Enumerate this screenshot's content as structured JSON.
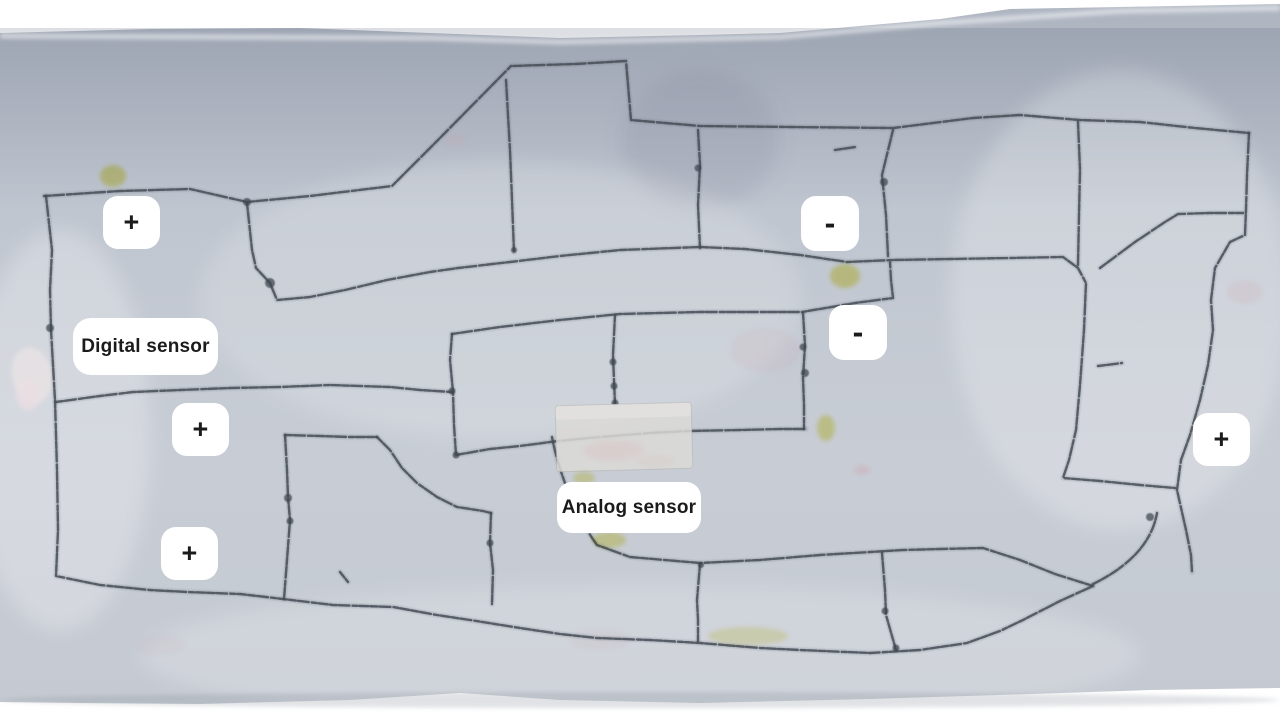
{
  "annotations": {
    "chip_color": "#ffffff",
    "text_color": "#1b1b1b",
    "labels": [
      {
        "name": "label-plus-top-left",
        "text": "+",
        "x": 103,
        "y": 196,
        "w": 57,
        "h": 53,
        "radius": 15,
        "font_size": 27
      },
      {
        "name": "label-minus-top",
        "text": "-",
        "x": 801,
        "y": 196,
        "w": 58,
        "h": 55,
        "radius": 15,
        "font_size": 32
      },
      {
        "name": "label-minus-middle",
        "text": "-",
        "x": 829,
        "y": 305,
        "w": 58,
        "h": 55,
        "radius": 15,
        "font_size": 32
      },
      {
        "name": "label-digital-sensor",
        "text": "Digital sensor",
        "x": 73,
        "y": 318,
        "w": 145,
        "h": 57,
        "radius": 18,
        "font_size": 19
      },
      {
        "name": "label-plus-middle-left",
        "text": "+",
        "x": 172,
        "y": 403,
        "w": 57,
        "h": 53,
        "radius": 15,
        "font_size": 27
      },
      {
        "name": "label-analog-sensor",
        "text": "Analog sensor",
        "x": 557,
        "y": 482,
        "w": 144,
        "h": 51,
        "radius": 15,
        "font_size": 19
      },
      {
        "name": "label-plus-bottom-left",
        "text": "+",
        "x": 161,
        "y": 527,
        "w": 57,
        "h": 53,
        "radius": 15,
        "font_size": 27
      },
      {
        "name": "label-plus-right",
        "text": "+",
        "x": 1193,
        "y": 413,
        "w": 57,
        "h": 53,
        "radius": 15,
        "font_size": 27
      }
    ]
  },
  "sketch": {
    "stroke_color": "#454c55",
    "knot_color": "#3e454e",
    "highlight_color": "#e3dd55",
    "cloth": {
      "outline": "M0,33 L150,29 L300,28 L430,33 L560,38 L700,35 L780,33 L860,26 L940,19 L1010,9 L1120,7 L1280,4 L1280,688 L1150,690 L1000,695 L870,699 L700,703 L560,700 L460,693 L350,700 L200,704 L80,703 L0,702 Z",
      "top_color": "#aeb5c1",
      "mid_color": "#c0c6d0",
      "base_color": "#c8cdd5"
    },
    "tape": {
      "x": 556,
      "y": 404,
      "w": 136,
      "h": 66,
      "rotate": -1.5,
      "color": "#dbd9d6"
    },
    "paths": [
      "M44,196 L120,191 L190,189 L247,202 L310,196 L392,186 L438,140 L511,66 L575,64 L626,61 L631,120 L700,126 L790,127 L893,128 L973,118 L1020,115 L1080,120 L1140,122 L1195,128 L1249,133",
      "M46,196 L52,250 L50,290 L51,330 L55,400 L57,470 L58,530 L56,576 L100,585 L150,590 L187,592 L240,594 L283,599 L333,605 L393,607 L437,615 L470,620 L520,628 L560,634 L597,638 L650,640 L700,643 L760,648 L800,650 L870,653 L920,650 L967,643 L1000,631 L1023,620 L1060,601 L1093,586",
      "M247,203 L252,250 L256,268 L270,283 L277,300 L310,297 L345,290 L387,280 L430,272 L458,268 L510,262 L560,256 L620,250 L700,247 L745,249 L800,255 L847,262 L893,260 L950,259 L1010,258 L1063,257 L1078,268 L1086,283 L1084,330 L1080,385 L1076,430 L1069,460 L1063,478 L1100,481 L1140,485 L1175,488",
      "M506,80 L510,150 L512,200 L514,252",
      "M698,130 L700,165 L698,205 L700,248",
      "M893,130 L882,175 L886,215 L888,256",
      "M1078,122 L1080,170 L1079,215 L1078,265",
      "M1249,133 L1247,175 L1246,210 L1245,235 L1230,242 L1215,268 L1211,300 L1213,330 L1208,365 L1200,400 L1190,435 L1181,460 L1177,490 L1186,530 L1191,555 L1192,572",
      "M1100,268 L1135,242 L1165,222 L1178,214 L1210,213 L1243,213",
      "M452,334 L500,327 L560,320 L620,314 L700,312 L760,312 L802,312 L855,303 L893,298 L891,280 L890,262",
      "M452,334 L450,360 L453,392 L454,425 L456,455 L490,449 L520,446 L558,441 L600,437 L650,433 L687,431 L740,430 L780,429 L806,429",
      "M56,402 L100,396 L133,392 L180,390 L230,388 L280,387 L330,385 L390,387 L420,390 L452,392",
      "M803,313 L805,345 L803,378 L804,405 L804,429",
      "M285,435 L320,436 L350,437 L377,437",
      "M285,435 L287,470 L288,497 L290,520 L287,560 L284,599",
      "M377,437 L390,450 L402,468 L417,483 L437,497 L457,507 L483,511 L491,513",
      "M491,513 L490,543 L493,570 L492,604",
      "M552,437 C558,470 575,515 597,545 L630,557 L700,563 L760,560 L820,555 L870,552 L903,550 L940,549 L983,548 L1020,560 L1055,574 L1093,586",
      "M1157,513 C1152,542 1130,566 1093,584",
      "M700,564 L697,600 L698,620 L698,641",
      "M882,553 L885,590 L886,615 L896,650",
      "M615,315 L613,355 L614,380 L615,404",
      "M1098,366 L1122,363",
      "M835,150 L855,147",
      "M340,572 L348,582"
    ],
    "knots": [
      [
        247,
        202,
        4
      ],
      [
        270,
        283,
        5
      ],
      [
        50,
        328,
        4
      ],
      [
        452,
        391,
        3.5
      ],
      [
        456,
        455,
        3.5
      ],
      [
        613,
        362,
        3.5
      ],
      [
        614,
        386,
        3.5
      ],
      [
        803,
        347,
        3.5
      ],
      [
        805,
        373,
        4
      ],
      [
        698,
        168,
        3.5
      ],
      [
        884,
        182,
        4
      ],
      [
        885,
        611,
        3.5
      ],
      [
        288,
        498,
        4
      ],
      [
        290,
        521,
        3.5
      ],
      [
        490,
        543,
        3.5
      ],
      [
        1150,
        517,
        4
      ],
      [
        896,
        648,
        3.5
      ],
      [
        701,
        565,
        3
      ],
      [
        514,
        250,
        3
      ],
      [
        615,
        403,
        3.5
      ]
    ],
    "highlights": [
      [
        113,
        176,
        13,
        11,
        0.6
      ],
      [
        845,
        276,
        15,
        12,
        0.6
      ],
      [
        826,
        428,
        9,
        13,
        0.55
      ],
      [
        584,
        478,
        11,
        6,
        0.45
      ],
      [
        609,
        540,
        17,
        8,
        0.5
      ],
      [
        748,
        636,
        40,
        9,
        0.3
      ]
    ],
    "smudges": [
      [
        765,
        350,
        35,
        22,
        0.12
      ],
      [
        1245,
        292,
        18,
        12,
        0.15
      ],
      [
        862,
        470,
        8,
        5,
        0.3
      ],
      [
        620,
        452,
        28,
        12,
        0.18
      ],
      [
        600,
        640,
        30,
        10,
        0.1
      ],
      [
        455,
        140,
        10,
        6,
        0.15
      ],
      [
        160,
        645,
        25,
        10,
        0.08
      ]
    ]
  }
}
